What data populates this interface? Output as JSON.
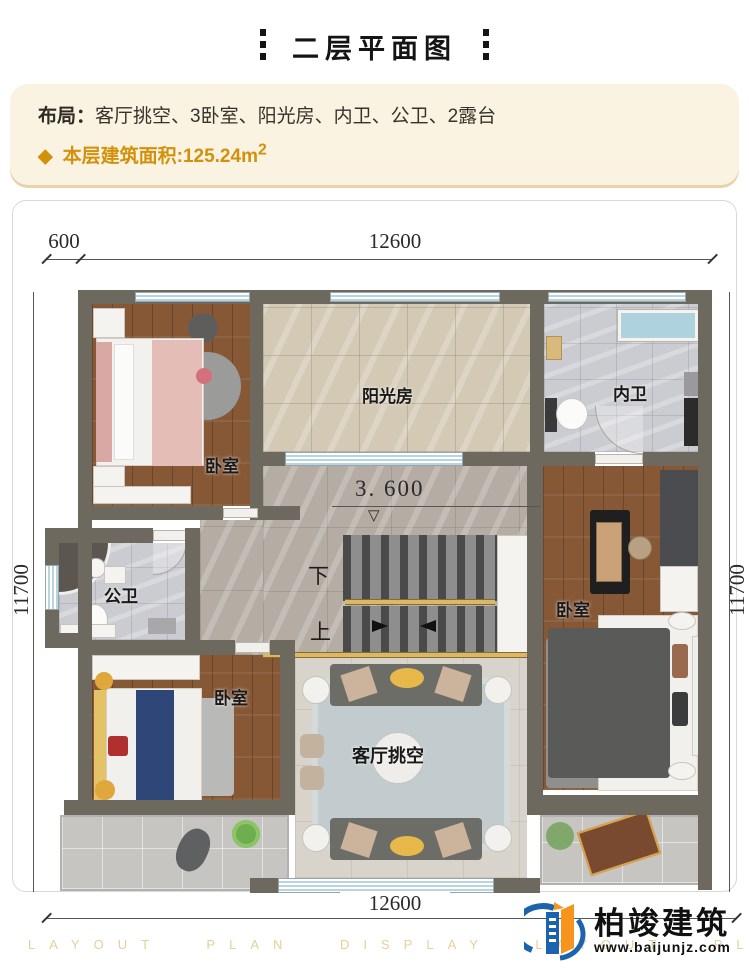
{
  "header": {
    "title": "二层平面图"
  },
  "info": {
    "layout_label": "布局：",
    "layout_value": "客厅挑空、3卧室、阳光房、内卫、公卫、2露台",
    "bullet": "◆",
    "area_label": "本层建筑面积:",
    "area_value": "125.24m",
    "area_sup": "2"
  },
  "dims": {
    "top_small": "600",
    "top_main": "12600",
    "left": "11700",
    "right": "11700",
    "bottom": "12600"
  },
  "rooms": {
    "bedroom_tl": "卧室",
    "sunroom": "阳光房",
    "ensuite": "内卫",
    "public_bath": "公卫",
    "bedroom_bl": "卧室",
    "bedroom_r": "卧室",
    "living_void": "客厅挑空",
    "elevation": "3. 600",
    "stair_down": "下",
    "stair_up": "上"
  },
  "footer": {
    "watermark": "LAYOUT PLAN DISPLAY LAYOUT PLAN DISPLAY",
    "brand": "柏竣建筑",
    "website": "www.baijunjz.com"
  },
  "colors": {
    "accent_gold": "#d2910c",
    "wall": "#6e695f",
    "info_bg": "#faf3e1"
  }
}
